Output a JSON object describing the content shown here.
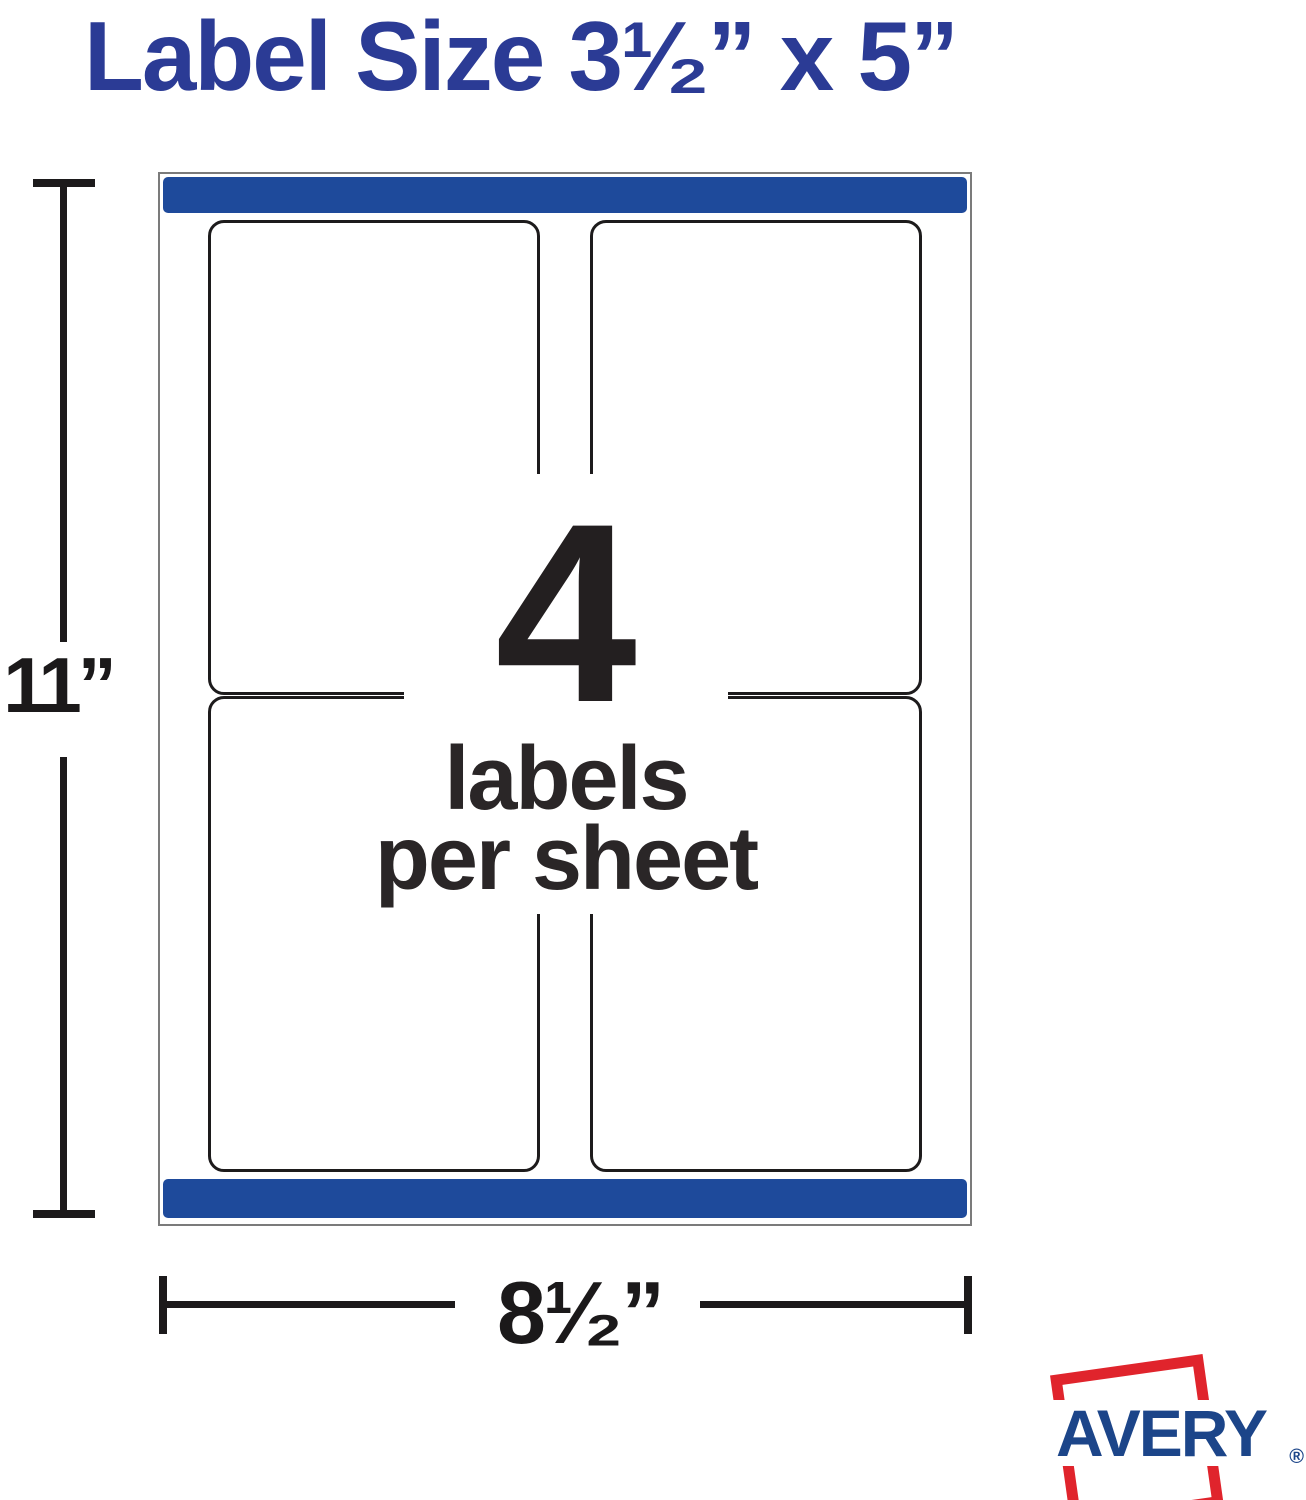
{
  "page": {
    "title": "Label Size 3¹⁄₂” x 5”"
  },
  "sheet_diagram": {
    "labels_count": "4",
    "caption_line1": "labels",
    "caption_line2": "per sheet",
    "columns": 2,
    "rows": 2
  },
  "dimensions": {
    "sheet_height": "11”",
    "sheet_width": "8¹⁄₂”"
  },
  "brand": {
    "name": "AVERY",
    "registered": "®"
  },
  "colors": {
    "title_blue": "#2b3b95",
    "sheet_bar_blue": "#1e4a9b",
    "label_border_dark": "#1d1b1c",
    "sheet_border_gray": "#7b7b7b",
    "ink_dark": "#231f20",
    "avery_blue": "#1c4589",
    "avery_red": "#e0242c"
  }
}
